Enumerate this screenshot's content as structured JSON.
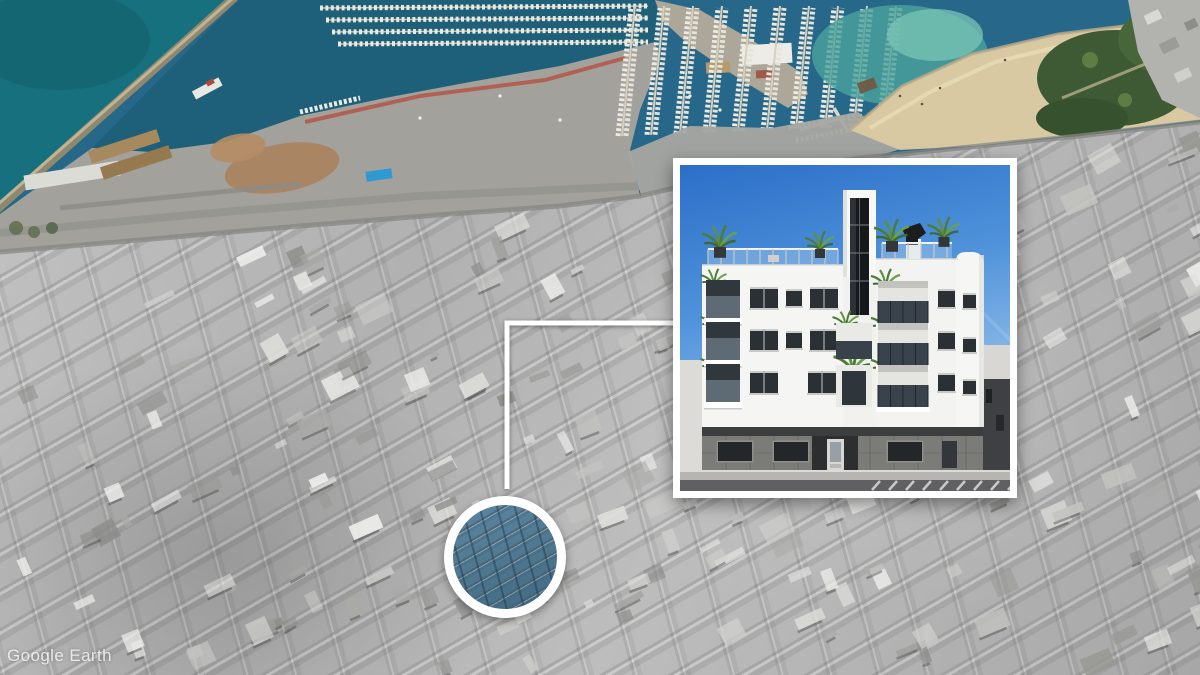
{
  "watermark": {
    "text": "Google Earth"
  },
  "overlay": {
    "marker": {
      "meaning": "highlighted development site",
      "ring_color": "#ffffff",
      "tint_color": "#5d87a0"
    },
    "connector": {
      "color": "#ffffff"
    },
    "inset": {
      "meaning": "new-build apartment facade render",
      "border_color": "#ffffff"
    }
  },
  "map": {
    "style": "oblique aerial photo, city desaturated, coast in color",
    "colors": {
      "sea": "#17707e",
      "harbor": "#1e6079",
      "marina": "#27688a",
      "shallow": "#4ba39b",
      "sand": "#d9c9a2",
      "vegetation": "#3e5a34",
      "city": "#b6b6b6",
      "sky_top": "#2b6fc9",
      "sky_mid": "#4f92da",
      "sky_bottom": "#a9cdee"
    }
  }
}
